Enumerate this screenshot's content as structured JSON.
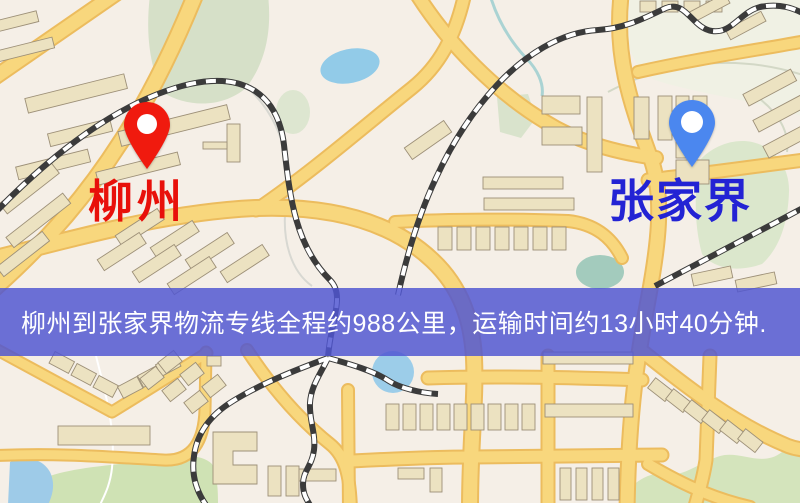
{
  "map": {
    "origin_marker": {
      "label": "柳州",
      "pin_color": "#f01a0e",
      "label_color": "#e8100a"
    },
    "destination_marker": {
      "label": "张家界",
      "pin_color": "#4b87ef",
      "label_color": "#2323d4"
    },
    "banner": {
      "text": "柳州到张家界物流专线全程约988公里，运输时间约13小时40分钟.",
      "background_color": "#5056d2",
      "text_color": "#ffffff",
      "distance_km": "988",
      "duration": "13小时40分钟"
    },
    "palette": {
      "map_background": "#f5efe7",
      "road_fill": "#f8d77d",
      "road_casing": "#ecbc5e",
      "building_fill": "#ece2c1",
      "building_stroke": "#9d9078",
      "park_green": "#d8e4c6",
      "water_blue": "#96cbe7",
      "railway_dark": "#3b3b3b"
    }
  }
}
